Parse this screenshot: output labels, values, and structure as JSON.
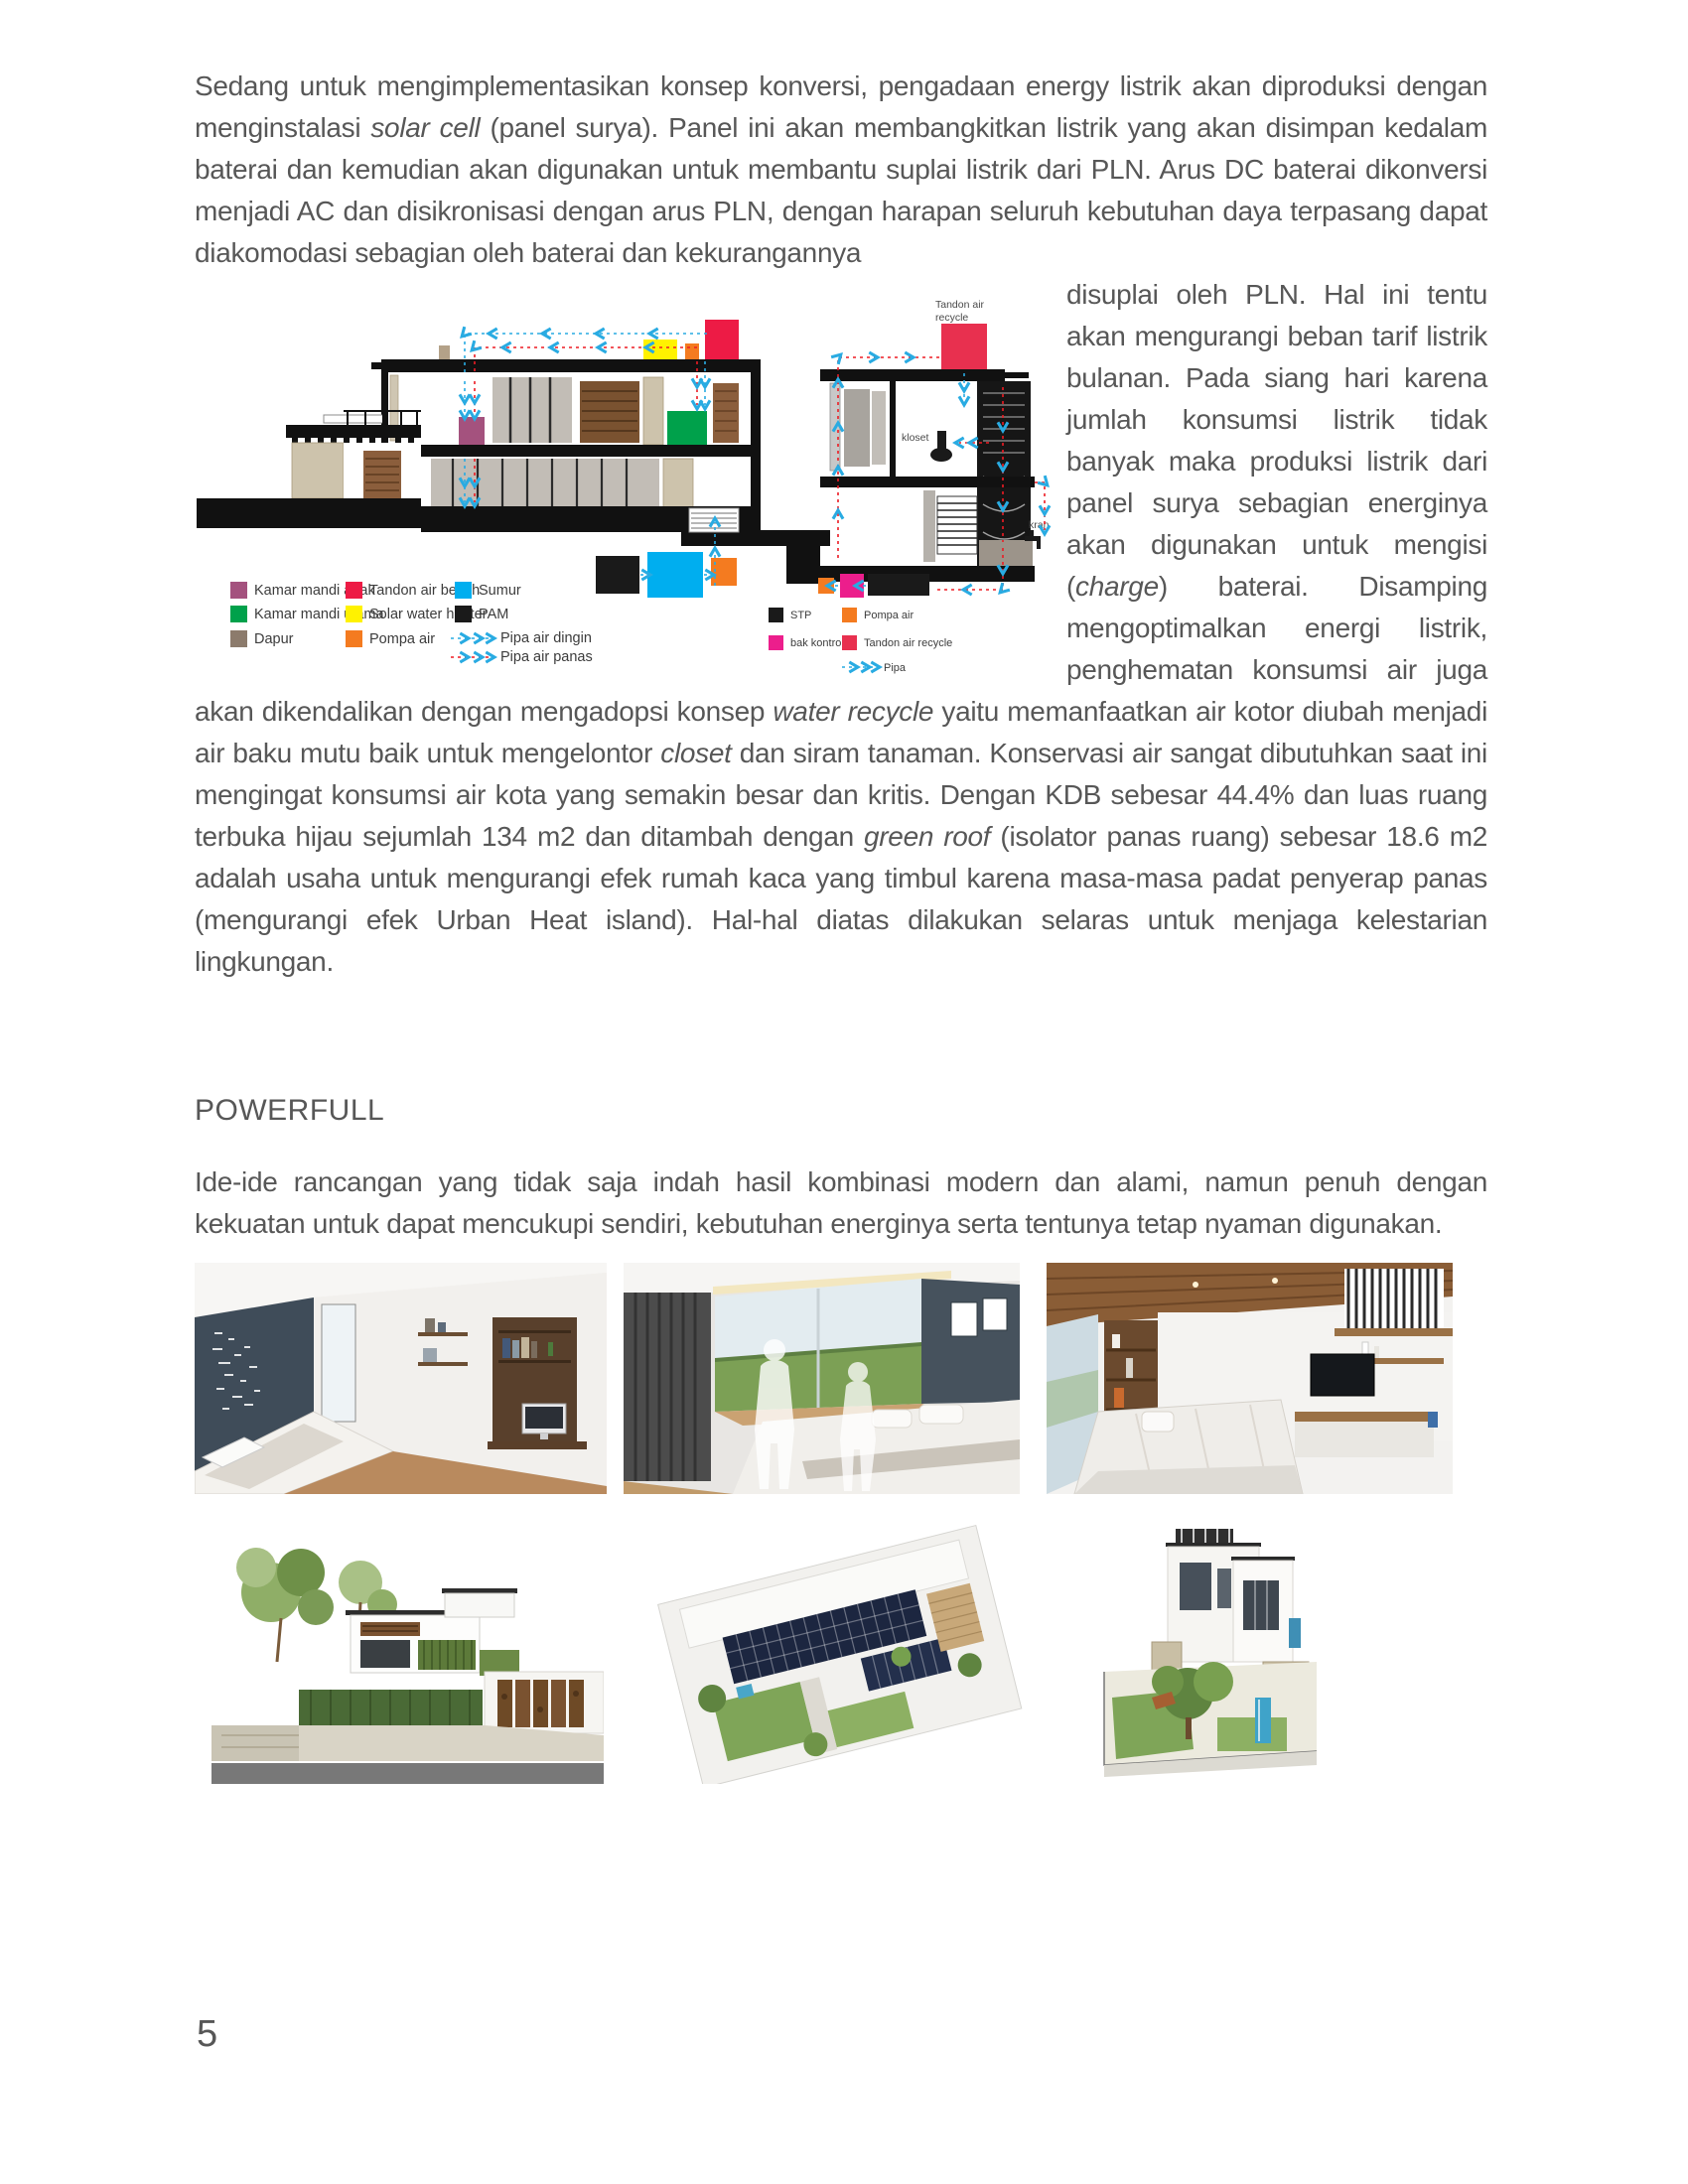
{
  "page": {
    "number": "5"
  },
  "colors": {
    "pipe_cold": "#29ABE2",
    "pipe_hot": "#ED1C24",
    "paper": "#ffffff",
    "text": "#575757"
  },
  "document": {
    "heading": "POWERFULL",
    "paragraph1": {
      "segments": [
        {
          "t": "Sedang untuk mengimplementasikan konsep konversi, pengadaan energy listrik akan diproduksi dengan menginstalasi "
        },
        {
          "t": "solar cell",
          "i": true
        },
        {
          "t": " (panel surya). Panel ini akan membangkitkan listrik yang akan disimpan kedalam baterai dan kemudian akan digunakan untuk membantu suplai listrik dari PLN. Arus DC baterai dikonversi menjadi AC dan disikronisasi dengan arus PLN, dengan harapan seluruh kebutuhan daya terpasang dapat diakomodasi sebagian oleh baterai dan kekurangannya"
        }
      ]
    },
    "paragraph2": {
      "segments": [
        {
          "t": "disuplai oleh PLN. Hal ini tentu akan mengurangi beban tarif listrik bulanan. Pada siang hari karena jumlah konsumsi listrik tidak banyak maka produksi listrik dari panel surya sebagian energinya akan digunakan untuk mengisi ("
        },
        {
          "t": "charge",
          "i": true
        },
        {
          "t": ") baterai. Disamping mengoptimalkan energi listrik, penghematan konsumsi air juga akan dikendalikan dengan mengadopsi konsep "
        },
        {
          "t": "water recycle",
          "i": true
        },
        {
          "t": " yaitu memanfaatkan air kotor diubah menjadi air baku mutu baik untuk mengelontor "
        },
        {
          "t": "closet",
          "i": true
        },
        {
          "t": " dan siram tanaman. Konservasi air sangat dibutuhkan saat ini mengingat konsumsi air kota yang semakin besar dan kritis. Dengan KDB sebesar 44.4% dan luas ruang terbuka hijau sejumlah 134 m2 dan ditambah dengan "
        },
        {
          "t": "green roof",
          "i": true
        },
        {
          "t": " (isolator panas ruang) sebesar 18.6 m2 adalah usaha untuk mengurangi efek rumah kaca yang timbul karena masa-masa padat penyerap panas (mengurangi efek Urban Heat island). Hal-hal diatas dilakukan selaras untuk menjaga kelestarian lingkungan."
        }
      ]
    },
    "paragraph3": {
      "segments": [
        {
          "t": "Ide-ide rancangan yang tidak saja indah hasil kombinasi modern dan alami, namun penuh dengan kekuatan untuk dapat mencukupi sendiri, kebutuhan energinya serta tentunya tetap nyaman digunakan."
        }
      ]
    }
  },
  "figure": {
    "labels": {
      "tandon_recycle_1": "Tandon air",
      "tandon_recycle_2": "recycle",
      "kloset": "kloset",
      "kran": "kran"
    },
    "legend_left": [
      {
        "color": "#A4527E",
        "label": "Kamar mandi anak"
      },
      {
        "color": "#00A14B",
        "label": "Kamar mandi utama"
      },
      {
        "color": "#8C7B6C",
        "label": "Dapur"
      },
      {
        "color": "#ED1B45",
        "label": "Tandon air bersih"
      },
      {
        "color": "#FFF200",
        "label": "Solar water heater"
      },
      {
        "color": "#F47B20",
        "label": "Pompa air"
      },
      {
        "color": "#00AEEF",
        "label": "Sumur"
      },
      {
        "color": "#1A1A1A",
        "label": "PAM"
      }
    ],
    "legend_left_pipes": [
      {
        "label": "Pipa air dingin"
      },
      {
        "label": "Pipa air panas"
      }
    ],
    "legend_right": [
      {
        "color": "#1A1A1A",
        "label": "STP"
      },
      {
        "color": "#EC1E8C",
        "label": "bak kontrol"
      },
      {
        "color": "#F47B20",
        "label": "Pompa air"
      },
      {
        "color": "#E8304F",
        "label": "Tandon air recycle"
      }
    ],
    "legend_right_pipe": {
      "label": "Pipa"
    }
  }
}
